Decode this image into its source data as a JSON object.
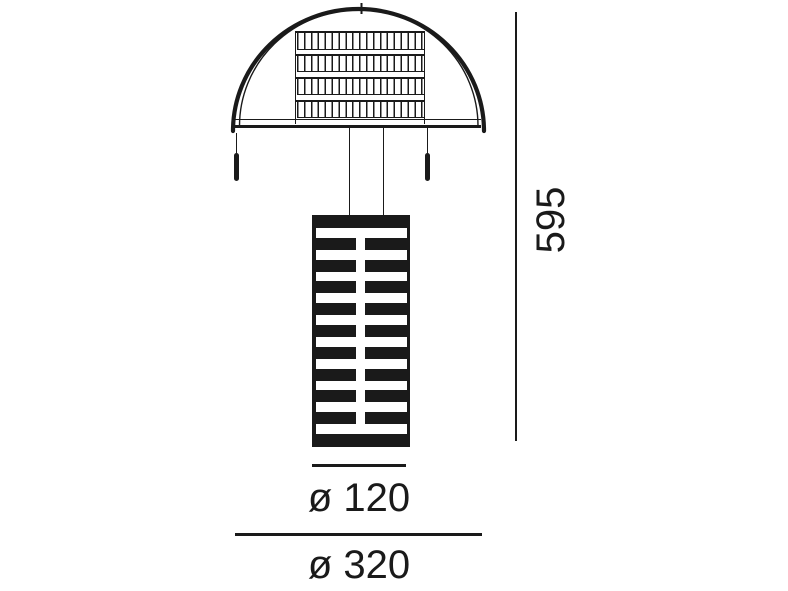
{
  "diagram": {
    "type": "product dimension drawing",
    "subject": "table lamp with dome wire shade and striped cylindrical body",
    "colors": {
      "ink": "#1a1a1a",
      "background": "#ffffff"
    },
    "dimensions": {
      "height": "595",
      "diameter_small": "ø 120",
      "diameter_large": "ø 320"
    },
    "shade": {
      "slat_rows": 4
    },
    "body": {
      "stripe_rows": 10,
      "stripe_first_top": 13,
      "stripe_pitch": 21.8
    }
  }
}
